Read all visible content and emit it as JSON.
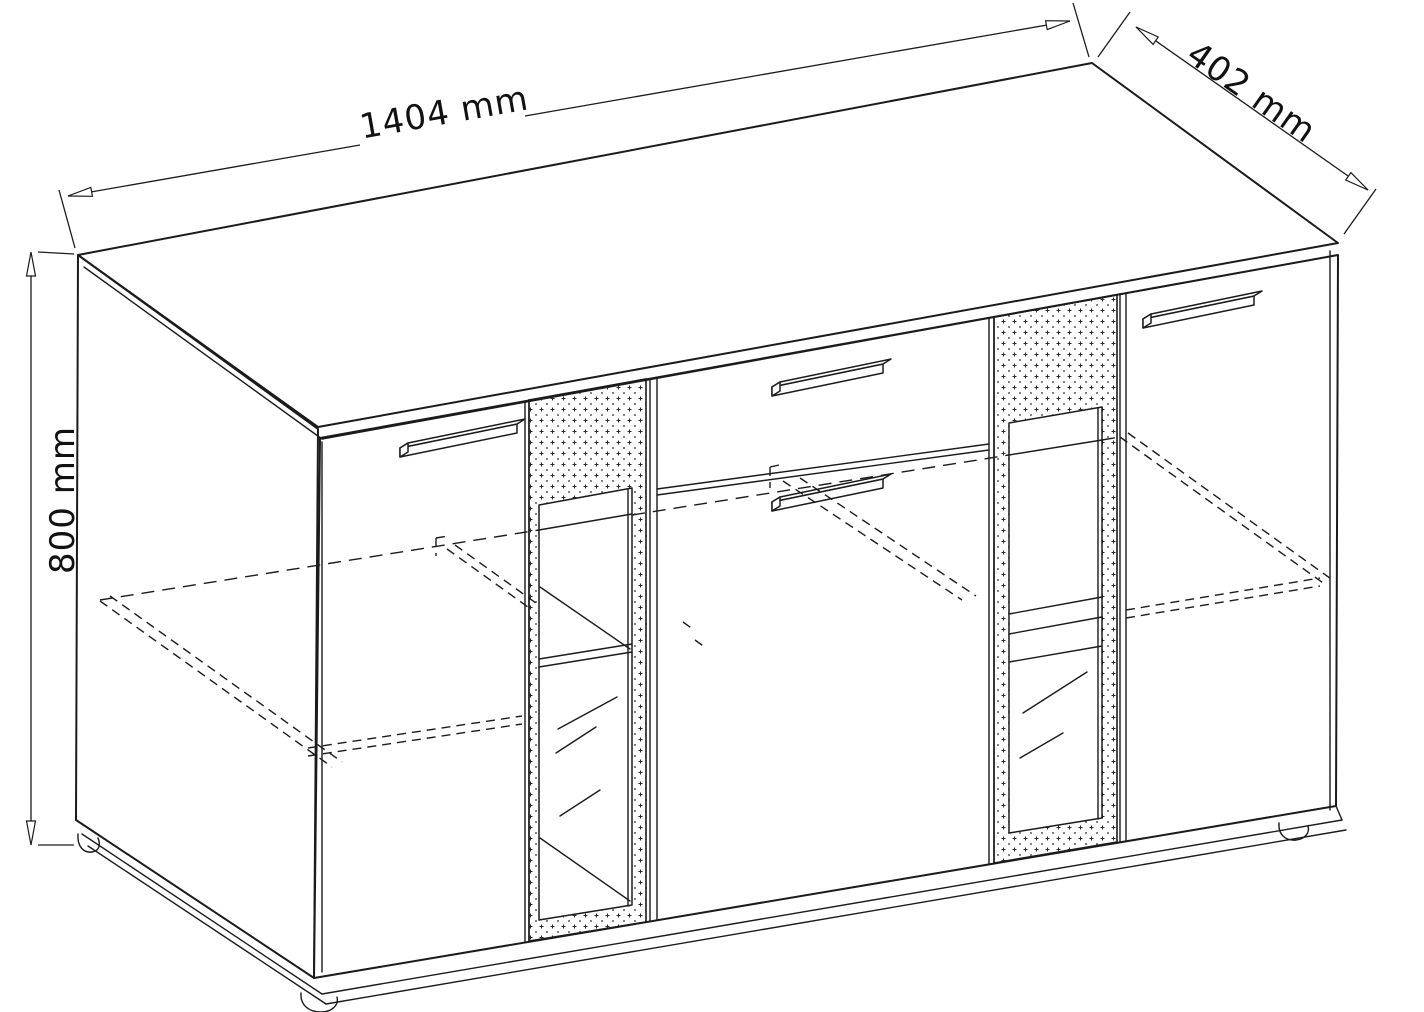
{
  "figure": {
    "kind": "furniture-dimension-diagram",
    "dimensions": {
      "width_label": "1404 mm",
      "depth_label": "402 mm",
      "height_label": "800 mm"
    }
  }
}
